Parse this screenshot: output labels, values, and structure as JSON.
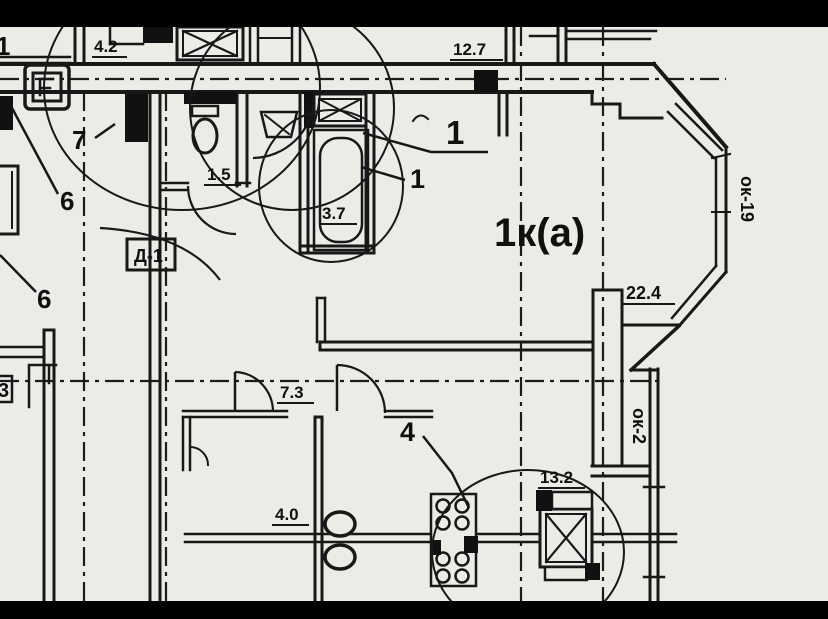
{
  "palette": {
    "paper": "#e9e7e2",
    "ink": "#1c1c1c",
    "bar": "#000000"
  },
  "room": {
    "label": "1к(а)"
  },
  "markers": {
    "door_box": "Д-1",
    "window_bay": "ок-19",
    "window_side": "ок-2"
  },
  "dims": {
    "top_left": "4.2",
    "top_center": "12.7",
    "wc": "1.5",
    "bath": "3.7",
    "bay": "22.4",
    "hall": "7.3",
    "left_room": "4.0",
    "kitchen": "13.2"
  },
  "callouts": {
    "one_a": "1",
    "one_b": "1",
    "four": "4",
    "six_a": "6",
    "six_b": "6",
    "seven": "7",
    "three": "3",
    "edge_one": "1"
  }
}
